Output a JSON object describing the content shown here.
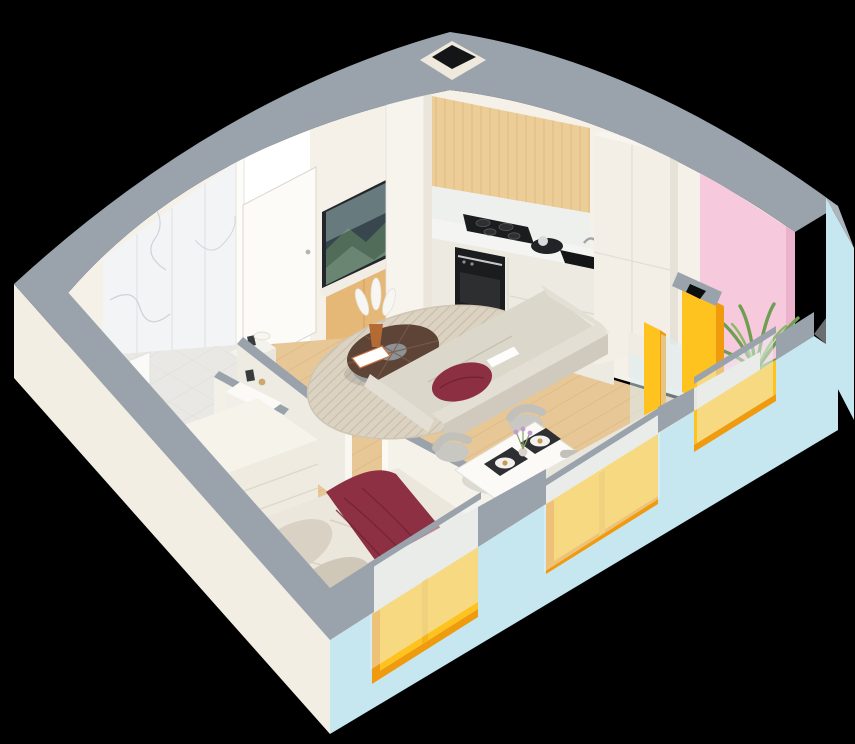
{
  "scene": {
    "title": "Isometric apartment floor plan",
    "description": "Cutaway 3D isometric render of a one-bedroom apartment: bathroom, hallway with washer niche, bedroom, open living room with kitchen, dining nook and a balcony with a palm plant, on a black background.",
    "view": "3d-isometric-cutaway",
    "background": "#000000"
  },
  "palette": {
    "background": "#000000",
    "wall_top": "#9aa3ab",
    "wall_top_dark": "#8f979f",
    "exterior_side": "#f3eee4",
    "exterior_front": "#c6e7f0",
    "wall_interior": "#f5f1e8",
    "wall_interior_bright": "#fbf8f1",
    "wall_interior_shadow": "#e9e6dd",
    "accent_pink": "#f6c9dd",
    "window_frame": "#ffc31f",
    "window_frame_shadow": "#f09a0e",
    "window_frame_light": "#ffd95c",
    "glass": "#dceef5",
    "floor_wood": "#e7c795",
    "floor_tile": "#e9e8e4",
    "marble": "#f3f4f5",
    "cabinet_wood": "#eccd97",
    "console_wood": "#e5b877",
    "counter": "#f4f5f2",
    "appliance": "#1b1c1e",
    "sofa": "#dbd7cb",
    "sofa_shade": "#cfcabd",
    "cushion_burgundy": "#8c2f42",
    "blanket_burgundy": "#8e3044",
    "bed_linen": "#ece7dd",
    "pillow": "#d9d2c4",
    "rug": "#dbd2c2",
    "rug_stripe": "#c3b8a4",
    "table_wood": "#5d4437",
    "dresser": "#efebe0",
    "concrete": "#d0d1cc",
    "plant": "#6f9e52",
    "tv_frame": "#23272b"
  },
  "rooms": [
    {
      "id": "bathroom",
      "label": "Bathroom",
      "items": [
        "marble tiled wall",
        "wall-hung toilet",
        "bathtub",
        "vanity"
      ]
    },
    {
      "id": "hallway",
      "label": "Hallway",
      "items": [
        "open white door",
        "washing machine niche"
      ]
    },
    {
      "id": "bedroom",
      "label": "Bedroom",
      "items": [
        "double bed",
        "burgundy throw blanket",
        "two pillows",
        "dresser"
      ]
    },
    {
      "id": "living-room",
      "label": "Living room",
      "items": [
        "wall-mounted TV",
        "wooden media console",
        "round coffee table",
        "vase with white feathers",
        "striped round rug",
        "beige sofa",
        "burgundy cushion",
        "magazine"
      ]
    },
    {
      "id": "kitchen",
      "label": "Kitchen",
      "items": [
        "wooden upper cabinets",
        "induction hob",
        "built-in oven",
        "sink",
        "kettle tray",
        "tall cabinets",
        "utility column"
      ]
    },
    {
      "id": "dining-nook",
      "label": "Dining nook",
      "items": [
        "white dining table",
        "four grey chairs",
        "placemats",
        "plates",
        "lavender vase"
      ]
    },
    {
      "id": "balcony",
      "label": "Balcony",
      "items": [
        "pink accent wall",
        "palm plant",
        "glass balustrade",
        "concrete floor"
      ]
    }
  ],
  "features": {
    "windows": 3,
    "hob_burners": 4,
    "vent_shafts": 1,
    "window_frame_color": "#ffc31f",
    "exterior_front_color": "#c6e7f0",
    "exterior_side_color": "#f3eee4"
  }
}
